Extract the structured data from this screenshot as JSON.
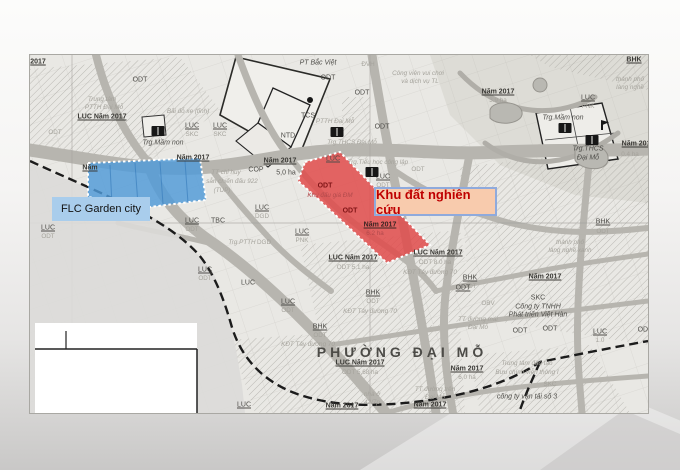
{
  "map": {
    "overlays": {
      "flc": {
        "label": "FLC Garden city",
        "fill": "#4f9ad8",
        "label_bg": "#a9cdec",
        "label_color": "#121212"
      },
      "research": {
        "label": "Khu đất nghiên cứu",
        "fill": "#e14b4b",
        "label_bg": "#f8cbad",
        "label_border": "#8faadc",
        "label_color": "#bf0000"
      }
    },
    "labels": [
      {
        "t": "2017",
        "x": 8,
        "y": 7,
        "c": "year"
      },
      {
        "t": "ODT",
        "x": 110,
        "y": 25,
        "c": "code"
      },
      {
        "t": "ODT",
        "x": 25,
        "y": 78,
        "c": "faint"
      },
      {
        "t": "Trung tâm",
        "x": 72,
        "y": 45,
        "c": "faint i"
      },
      {
        "t": "PTTH Đại Mỗ",
        "x": 74,
        "y": 53,
        "c": "faint i"
      },
      {
        "t": "LUC Năm 2017",
        "x": 72,
        "y": 62,
        "c": "year"
      },
      {
        "t": "Bãi đỗ xe (tĩnh)",
        "x": 158,
        "y": 57,
        "c": "faint i"
      },
      {
        "t": "LUC",
        "x": 162,
        "y": 71,
        "c": "code u"
      },
      {
        "t": "SKC",
        "x": 162,
        "y": 80,
        "c": "faint"
      },
      {
        "t": "LUC",
        "x": 190,
        "y": 71,
        "c": "code u"
      },
      {
        "t": "SKC",
        "x": 190,
        "y": 80,
        "c": "faint"
      },
      {
        "t": "Trg.Mầm non",
        "x": 133,
        "y": 88,
        "c": "code i"
      },
      {
        "t": "Năm 2017",
        "x": 163,
        "y": 103,
        "c": "year"
      },
      {
        "t": "Năm",
        "x": 60,
        "y": 113,
        "c": "year"
      },
      {
        "t": "PT Bắc Việt",
        "x": 288,
        "y": 8,
        "c": "code i"
      },
      {
        "t": "ODT",
        "x": 298,
        "y": 23,
        "c": "code"
      },
      {
        "t": "ODT",
        "x": 332,
        "y": 38,
        "c": "code"
      },
      {
        "t": "TCS",
        "x": 278,
        "y": 61,
        "c": "code"
      },
      {
        "t": "NTD",
        "x": 258,
        "y": 81,
        "c": "code"
      },
      {
        "t": "ĐVH",
        "x": 338,
        "y": 10,
        "c": "faint"
      },
      {
        "t": "Công viên vui chơi",
        "x": 388,
        "y": 19,
        "c": "faint i"
      },
      {
        "t": "và dịch vụ TL",
        "x": 390,
        "y": 27,
        "c": "faint i"
      },
      {
        "t": "PTTH Đại Mỗ",
        "x": 305,
        "y": 67,
        "c": "faint i"
      },
      {
        "t": "ODT",
        "x": 352,
        "y": 72,
        "c": "code"
      },
      {
        "t": "Trg.THCS Đại Mỗ",
        "x": 322,
        "y": 88,
        "c": "faint i"
      },
      {
        "t": "LUC",
        "x": 303,
        "y": 104,
        "c": "code u"
      },
      {
        "t": "Trg.Tiểu học công lập",
        "x": 348,
        "y": 108,
        "c": "faint i"
      },
      {
        "t": "LUC",
        "x": 353,
        "y": 122,
        "c": "code u"
      },
      {
        "t": "ODT",
        "x": 353,
        "y": 131,
        "c": "faint"
      },
      {
        "t": "ODT",
        "x": 388,
        "y": 115,
        "c": "faint"
      },
      {
        "t": "Năm 2017",
        "x": 250,
        "y": 106,
        "c": "year"
      },
      {
        "t": "COP",
        "x": 226,
        "y": 115,
        "c": "code"
      },
      {
        "t": "5,0 ha",
        "x": 256,
        "y": 118,
        "c": "code"
      },
      {
        "t": "TT chỉ huy",
        "x": 196,
        "y": 118,
        "c": "faint i"
      },
      {
        "t": "sẵn chiến đấu 922",
        "x": 202,
        "y": 127,
        "c": "faint i"
      },
      {
        "t": "(TUP)",
        "x": 192,
        "y": 136,
        "c": "faint i"
      },
      {
        "t": "Năm 2017",
        "x": 468,
        "y": 37,
        "c": "year"
      },
      {
        "t": "3.9 ha",
        "x": 468,
        "y": 46,
        "c": "faint"
      },
      {
        "t": "BHK",
        "x": 604,
        "y": 5,
        "c": "year"
      },
      {
        "t": "thành phố",
        "x": 600,
        "y": 25,
        "c": "faint i"
      },
      {
        "t": "làng nghề",
        "x": 600,
        "y": 33,
        "c": "faint i"
      },
      {
        "t": "LUC",
        "x": 558,
        "y": 43,
        "c": "code u"
      },
      {
        "t": "PNK",
        "x": 558,
        "y": 52,
        "c": "faint"
      },
      {
        "t": "Trg.Mầm non",
        "x": 533,
        "y": 63,
        "c": "code i"
      },
      {
        "t": "Trg.THCS",
        "x": 558,
        "y": 94,
        "c": "code i"
      },
      {
        "t": "Đại Mỗ",
        "x": 558,
        "y": 103,
        "c": "code i"
      },
      {
        "t": "Năm 2017",
        "x": 608,
        "y": 89,
        "c": "year"
      },
      {
        "t": "0.4 ha",
        "x": 600,
        "y": 100,
        "c": "faint"
      },
      {
        "t": "ODT",
        "x": 295,
        "y": 131,
        "c": "red"
      },
      {
        "t": "Khu đấu giá ĐM",
        "x": 300,
        "y": 141,
        "c": "redf i"
      },
      {
        "t": "ODT",
        "x": 320,
        "y": 156,
        "c": "red"
      },
      {
        "t": "Năm 2017",
        "x": 350,
        "y": 170,
        "c": "redy"
      },
      {
        "t": "6.2 ha",
        "x": 345,
        "y": 179,
        "c": "redf"
      },
      {
        "t": "LUC",
        "x": 162,
        "y": 166,
        "c": "code u"
      },
      {
        "t": "ODT",
        "x": 162,
        "y": 175,
        "c": "faint"
      },
      {
        "t": "TBC",
        "x": 188,
        "y": 166,
        "c": "code"
      },
      {
        "t": "LUC",
        "x": 232,
        "y": 153,
        "c": "code u"
      },
      {
        "t": "DGD",
        "x": 232,
        "y": 162,
        "c": "faint"
      },
      {
        "t": "LUC",
        "x": 18,
        "y": 173,
        "c": "code u"
      },
      {
        "t": "ODT",
        "x": 18,
        "y": 182,
        "c": "faint"
      },
      {
        "t": "Trg.PTTH",
        "x": 212,
        "y": 188,
        "c": "faint i"
      },
      {
        "t": "DGD",
        "x": 234,
        "y": 188,
        "c": "faint"
      },
      {
        "t": "LUC",
        "x": 175,
        "y": 215,
        "c": "code u"
      },
      {
        "t": "ODT",
        "x": 175,
        "y": 224,
        "c": "faint"
      },
      {
        "t": "LUC",
        "x": 218,
        "y": 228,
        "c": "code"
      },
      {
        "t": "LUC",
        "x": 258,
        "y": 247,
        "c": "code u"
      },
      {
        "t": "ODT",
        "x": 258,
        "y": 256,
        "c": "faint"
      },
      {
        "t": "BHK",
        "x": 290,
        "y": 272,
        "c": "code u"
      },
      {
        "t": "ODT",
        "x": 290,
        "y": 281,
        "c": "faint"
      },
      {
        "t": "KĐT Tây đường 70",
        "x": 278,
        "y": 290,
        "c": "faint i"
      },
      {
        "t": "LUC",
        "x": 272,
        "y": 177,
        "c": "code u"
      },
      {
        "t": "PNK",
        "x": 272,
        "y": 186,
        "c": "faint"
      },
      {
        "t": "LUC Năm 2017",
        "x": 323,
        "y": 203,
        "c": "year"
      },
      {
        "t": "ODT  5,1 ha",
        "x": 323,
        "y": 213,
        "c": "faint"
      },
      {
        "t": "LUC Năm 2017",
        "x": 408,
        "y": 198,
        "c": "year"
      },
      {
        "t": "ODT  8.0 ha",
        "x": 405,
        "y": 208,
        "c": "faint"
      },
      {
        "t": "KĐT Tây đường 70",
        "x": 400,
        "y": 218,
        "c": "faint i"
      },
      {
        "t": "BHK",
        "x": 440,
        "y": 223,
        "c": "code u"
      },
      {
        "t": "ODT",
        "x": 440,
        "y": 232,
        "c": "faint"
      },
      {
        "t": "BHK",
        "x": 343,
        "y": 238,
        "c": "code u"
      },
      {
        "t": "ODT",
        "x": 343,
        "y": 247,
        "c": "faint"
      },
      {
        "t": "KĐT Tây đường 70",
        "x": 340,
        "y": 257,
        "c": "faint i"
      },
      {
        "t": "BHK",
        "x": 573,
        "y": 167,
        "c": "code u"
      },
      {
        "t": "ODT",
        "x": 573,
        "y": 177,
        "c": "faint"
      },
      {
        "t": "thành phố",
        "x": 540,
        "y": 188,
        "c": "faint i"
      },
      {
        "t": "làng nghề xanh",
        "x": 540,
        "y": 196,
        "c": "faint i"
      },
      {
        "t": "ODT",
        "x": 433,
        "y": 233,
        "c": "code u"
      },
      {
        "t": "TT đường mái",
        "x": 448,
        "y": 265,
        "c": "faint i"
      },
      {
        "t": "Đại Mỗ",
        "x": 448,
        "y": 273,
        "c": "faint i"
      },
      {
        "t": "PHƯỜNG  ĐẠI  MỖ",
        "x": 372,
        "y": 297,
        "c": "big"
      },
      {
        "t": "LUC Năm 2017",
        "x": 330,
        "y": 308,
        "c": "year"
      },
      {
        "t": "ODT  5,68 ha",
        "x": 330,
        "y": 318,
        "c": "faint"
      },
      {
        "t": "nhà ở",
        "x": 342,
        "y": 340,
        "c": "faint i"
      },
      {
        "t": "42/7p",
        "x": 342,
        "y": 348,
        "c": "faint i"
      },
      {
        "t": "Năm 2017",
        "x": 437,
        "y": 314,
        "c": "year"
      },
      {
        "t": "6.0 ha",
        "x": 437,
        "y": 323,
        "c": "faint"
      },
      {
        "t": "TT đường trên",
        "x": 405,
        "y": 335,
        "c": "faint i"
      },
      {
        "t": "Đại Mỗ",
        "x": 405,
        "y": 343,
        "c": "faint i"
      },
      {
        "t": "Năm 2017",
        "x": 312,
        "y": 351,
        "c": "year"
      },
      {
        "t": "Năm 2017",
        "x": 400,
        "y": 350,
        "c": "year"
      },
      {
        "t": "SKC",
        "x": 508,
        "y": 243,
        "c": "code"
      },
      {
        "t": "Công ty TNHH",
        "x": 508,
        "y": 252,
        "c": "code i"
      },
      {
        "t": "Phát triển Việt Hàn",
        "x": 508,
        "y": 260,
        "c": "code i"
      },
      {
        "t": "OBV",
        "x": 458,
        "y": 249,
        "c": "faint"
      },
      {
        "t": "Năm 2017",
        "x": 515,
        "y": 222,
        "c": "year"
      },
      {
        "t": "ODT",
        "x": 490,
        "y": 276,
        "c": "code"
      },
      {
        "t": "ODT",
        "x": 520,
        "y": 274,
        "c": "code"
      },
      {
        "t": "LUC",
        "x": 570,
        "y": 277,
        "c": "code u"
      },
      {
        "t": "1.0",
        "x": 570,
        "y": 286,
        "c": "faint"
      },
      {
        "t": "ODT",
        "x": 615,
        "y": 275,
        "c": "code"
      },
      {
        "t": "Trung tâm đào tạo",
        "x": 497,
        "y": 309,
        "c": "faint i"
      },
      {
        "t": "Bưu chính viễn thông I",
        "x": 497,
        "y": 318,
        "c": "faint i"
      },
      {
        "t": "SKC",
        "x": 520,
        "y": 330,
        "c": "faint"
      },
      {
        "t": "công ty vận tải số 3",
        "x": 497,
        "y": 342,
        "c": "code i"
      },
      {
        "t": "LUC",
        "x": 214,
        "y": 350,
        "c": "code u"
      }
    ],
    "icons": [
      {
        "type": "book",
        "x": 128,
        "y": 76
      },
      {
        "type": "book",
        "x": 307,
        "y": 77
      },
      {
        "type": "book",
        "x": 342,
        "y": 117
      },
      {
        "type": "book",
        "x": 535,
        "y": 73
      },
      {
        "type": "book",
        "x": 562,
        "y": 85
      },
      {
        "type": "dot",
        "x": 280,
        "y": 45
      },
      {
        "type": "flag",
        "x": 575,
        "y": 70
      }
    ]
  }
}
